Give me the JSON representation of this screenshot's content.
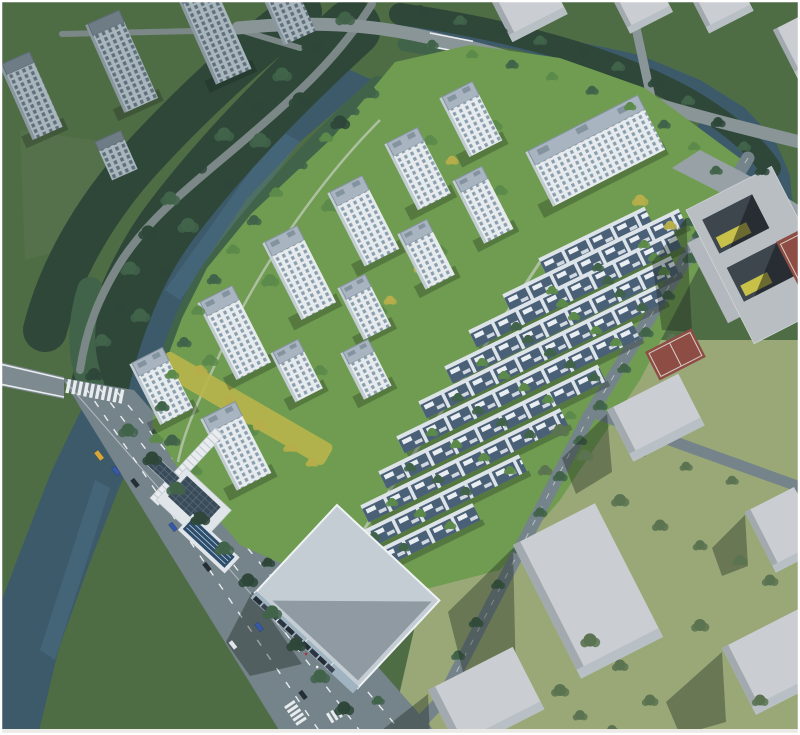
{
  "scene": {
    "title": "Aerial architectural rendering of riverside residential development",
    "description": "Bird's-eye master-plan rendering: white high-rise residential towers and parallel rows of low-rise townhouses on a green riverside site, bounded by tree-lined canals, a wide arterial road with a clubhouse and swimming pool at the southwest entrance, a school block with courtyards and red sports courts to the east, darker existing apartment towers to the northwest, and plain gray context massing blocks to the south and east.",
    "inventory": {
      "residential_towers": 13,
      "townhouse_rows": 10,
      "context_towers_northwest": 5,
      "context_blocks_north": 4,
      "context_massing_blocks_south": 5,
      "canals": 2,
      "bridges": 2,
      "sports_courts": 2,
      "swimming_pools": 1,
      "cars_on_road": 8,
      "parked_cars": 10
    }
  },
  "colors": {
    "water": "#3d5a6b",
    "waterLight": "#4e7287",
    "treeDark": "#2e4739",
    "treeMid": "#41634a",
    "treeLight": "#5c8a4a",
    "treeBright": "#6f9c50",
    "treeYellow": "#b6ae4a",
    "treeOlive": "#5b7350",
    "grassBase": "#4f6d45",
    "lawn": "#6f9c50",
    "grassSun": "#9aa878",
    "meadow": "#55714b",
    "road": "#75838a",
    "roadLight": "#8a9597",
    "roadPark": "#7b8887",
    "laneMark": "#e8ecee",
    "towerRoof": "#a8b4bf",
    "towerRoofEdge": "#8493a0",
    "towerFacade": "#e7ebee",
    "towerWindow": "#8aa0af",
    "towerSide": "#c2ccd3",
    "contextRoof": "#6e7c86",
    "contextFacade": "#a9b6be",
    "contextWindow": "#5f707b",
    "thWall": "#dde4e9",
    "thRoof": "#4a6077",
    "thPanel": "#e9eef2",
    "blockTop": "#cacdd1",
    "blockSide": "#a2a9af",
    "blockLight": "#d6d8da",
    "schoolBody": "#b9bec3",
    "schoolCourt": "#3e464d",
    "schoolYellow": "#d6ce4a",
    "courtRed": "#8e4d44",
    "pool": "#2d4d6d",
    "solar": "#394a59",
    "canopy": "#e8ecef",
    "gardenYellow": "#b9b54b",
    "carDark": "#252d36",
    "carBlue": "#3558a8",
    "carWhite": "#dfe5e8",
    "carYellow": "#d9a63a"
  }
}
